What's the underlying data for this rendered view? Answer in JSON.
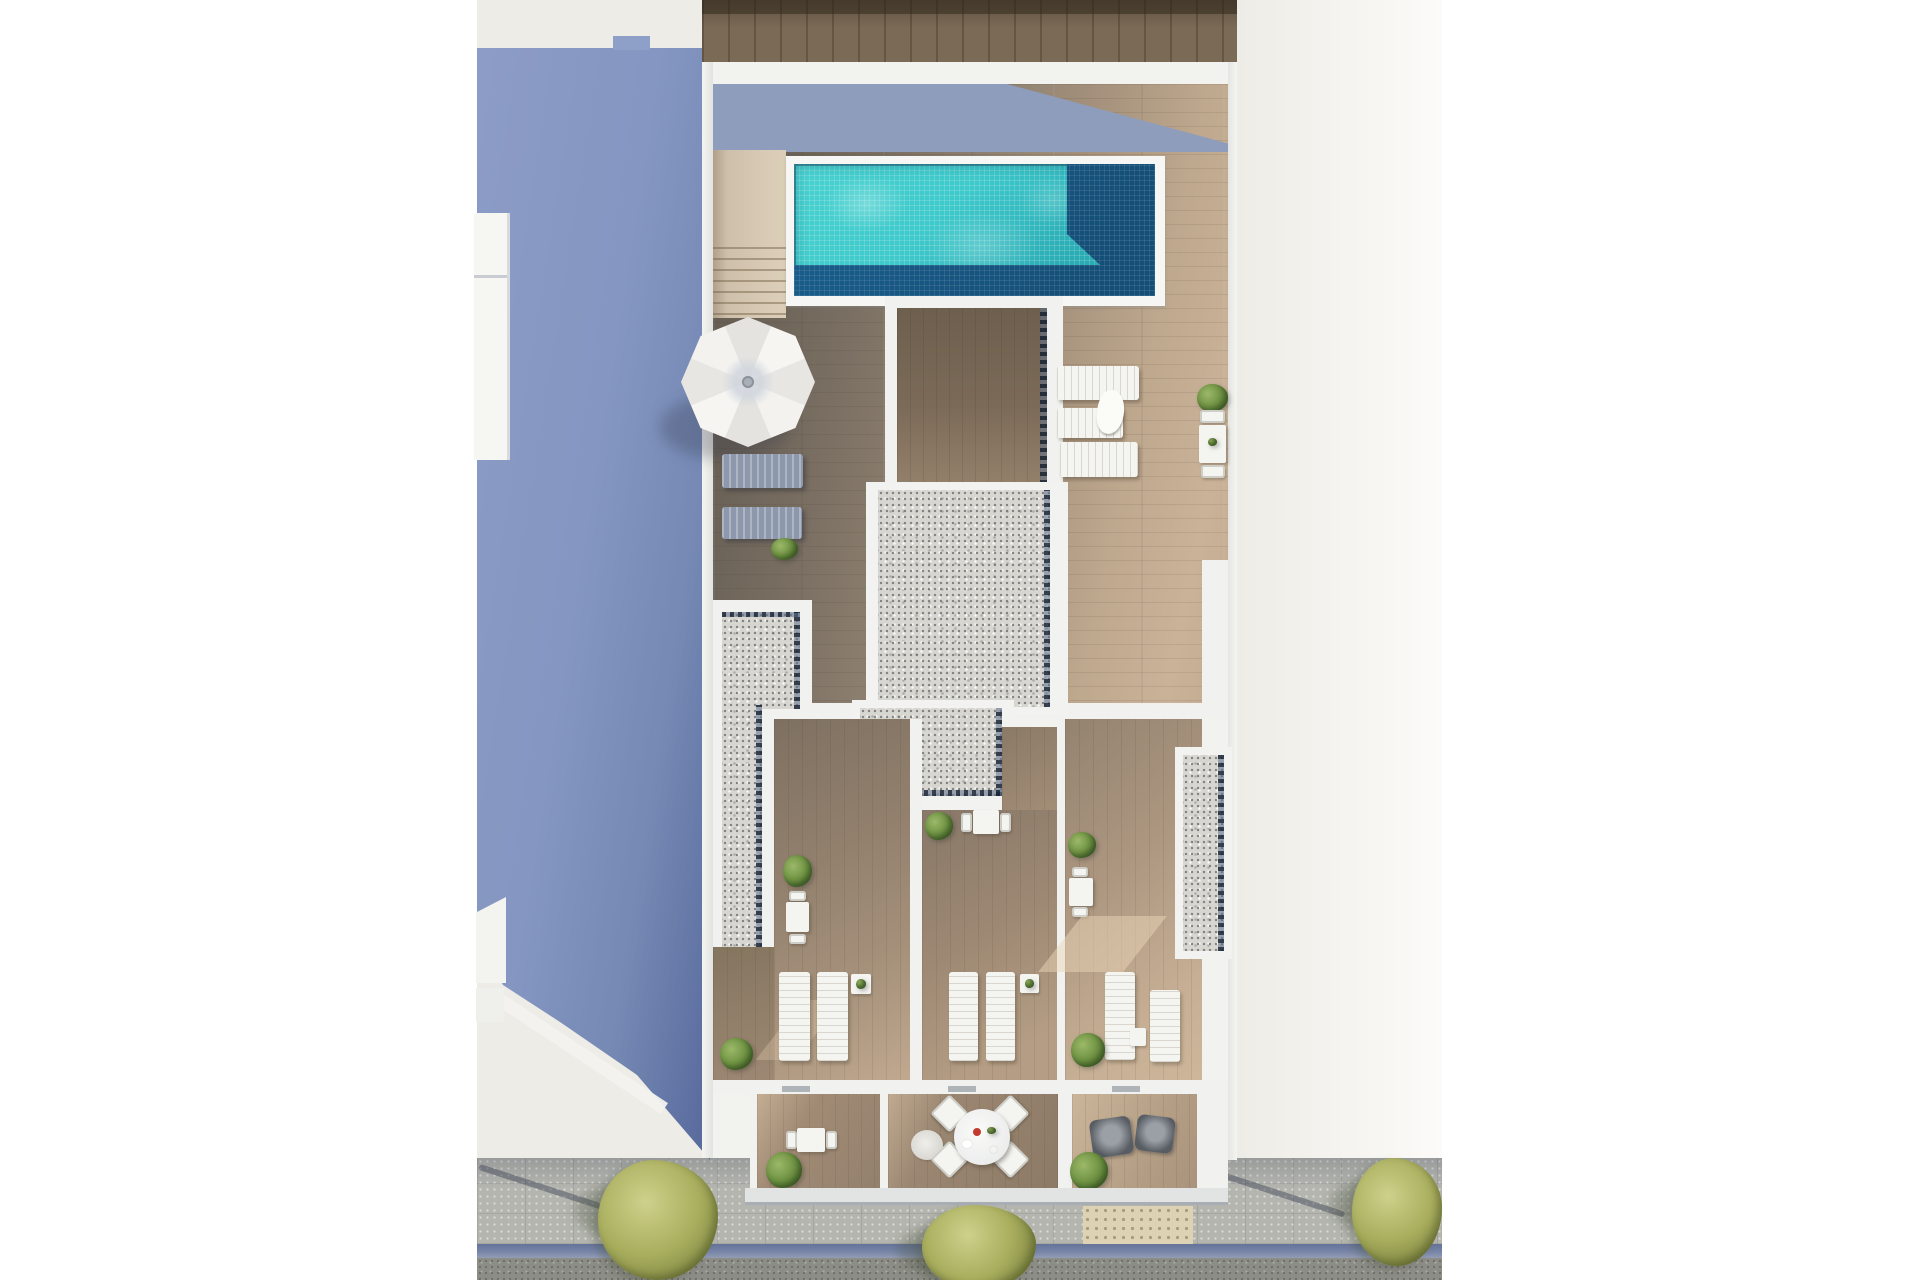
{
  "scene": {
    "label": "aerial-rooftop-floorplan-render",
    "kind": "top-down 3D architectural rendering",
    "features": [
      "swimming pool with mosaic water",
      "rooftop wood deck",
      "parasol",
      "sun loungers",
      "gravel roof sections",
      "three private terraces",
      "three ground patios",
      "street with sidewalk, curb, road and trees",
      "neighbouring building shadow in periwinkle blue"
    ]
  },
  "objects": {
    "swimming_pool": 1,
    "staircase": 1,
    "parasol": 1,
    "sun_loungers_white": 9,
    "sun_loungers_gray": 2,
    "dining_table_sets_small": 5,
    "round_dining_set_chairs": 4,
    "lounge_armchairs": 2,
    "side_tables": 3,
    "gravel_roof_sections": 3,
    "gravel_planter_strips": 1,
    "plants_and_bushes": 11,
    "street_trees": 3,
    "balcony_boxes_left": 2,
    "pole_shadows_on_sidewalk": 2
  },
  "palette": {
    "white": "#ffffff",
    "offwhite": "#eeece6",
    "offwhite_right": "#f6f4f0",
    "wall_white": "#f1f2ef",
    "blue_light": "#8c9cc6",
    "blue_mid": "#8496c1",
    "blue_dark": "#56689a",
    "shadow_wedge": "#8e9dbb",
    "wood_top": "#7b6a56",
    "wood_top_dark": "#4b4238",
    "pool_light": "#3ec9cb",
    "pool_light2": "#2aacb4",
    "pool_deep": "#1a5f8d",
    "stairs_beige": "#d6c7b2",
    "deck_dark": "#5f574e",
    "deck_mid": "#8f8171",
    "deck_light": "#c9b298",
    "courtyard_wood": "#75654f",
    "terrace_wood": "#a6917b",
    "patio_wood": "#9a8671",
    "gravel": "#d7d6d1",
    "drain_dark": "#2c3d55",
    "furniture_white": "#f4f4f1",
    "lounger_gray": "#8d98ac",
    "armchair": "#585d64",
    "bush_green": "#6f9343",
    "bush_green_light": "#9cb968",
    "bush_green_dark": "#4e7030",
    "tree_olive": "#a9ae5e",
    "tree_olive_light": "#ced18b",
    "tree_olive_dark": "#7c8440",
    "sidewalk": "#b4b5af",
    "tactile": "#ded2b4",
    "curb_blue": "#7a87a8",
    "road": "#8d8d87"
  }
}
